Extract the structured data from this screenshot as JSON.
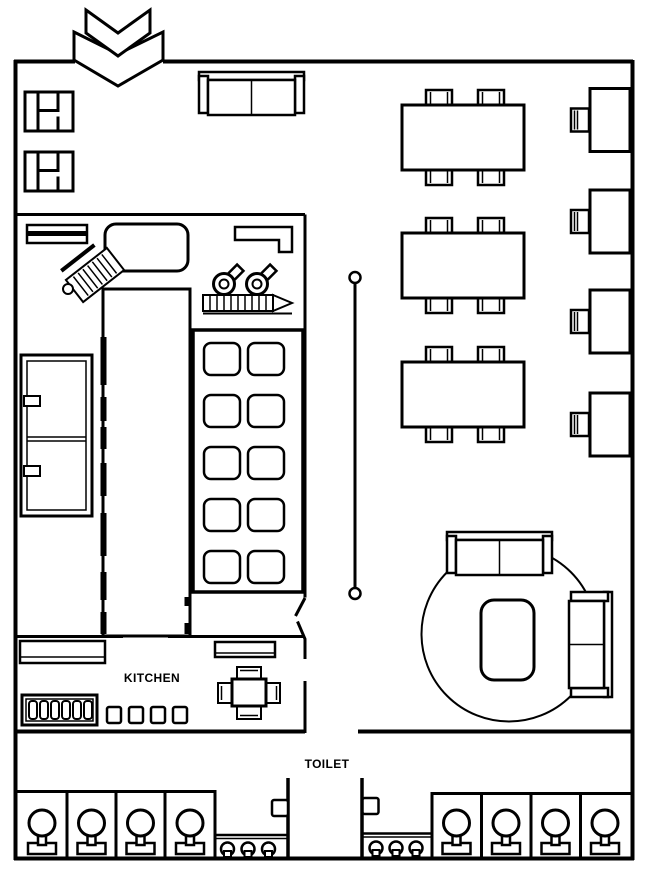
{
  "colors": {
    "background": "#ffffff",
    "line": "#000000"
  },
  "labels": {
    "kitchen": "KITCHEN",
    "toilet": "TOILET"
  },
  "entrance": {
    "symbol": "double-chevron-down",
    "chevrons": 2
  },
  "inventory": {
    "entry_booth_tables": 2,
    "entry_sofa": 1,
    "dining_tables": {
      "count": 3,
      "chairs_each": 4
    },
    "wall_tables": {
      "count": 4,
      "chairs_each": 1
    },
    "divider_rail_posts": 2,
    "lounge": {
      "sofas": 2,
      "round_rug": 1,
      "coffee_table": 1
    },
    "kitchen": {
      "stove_burners": 10,
      "fridge_doors": 2,
      "island_counter": 1,
      "faucets": 2,
      "prep_table": 1,
      "pass_counters": 2,
      "staff_table_chairs": 4,
      "bottle_rack_slots": 6,
      "prep_trays": 4
    },
    "toilets": {
      "rooms": 2,
      "stalls_per_room": 4,
      "sinks_per_room": 3,
      "doors": 2
    }
  }
}
